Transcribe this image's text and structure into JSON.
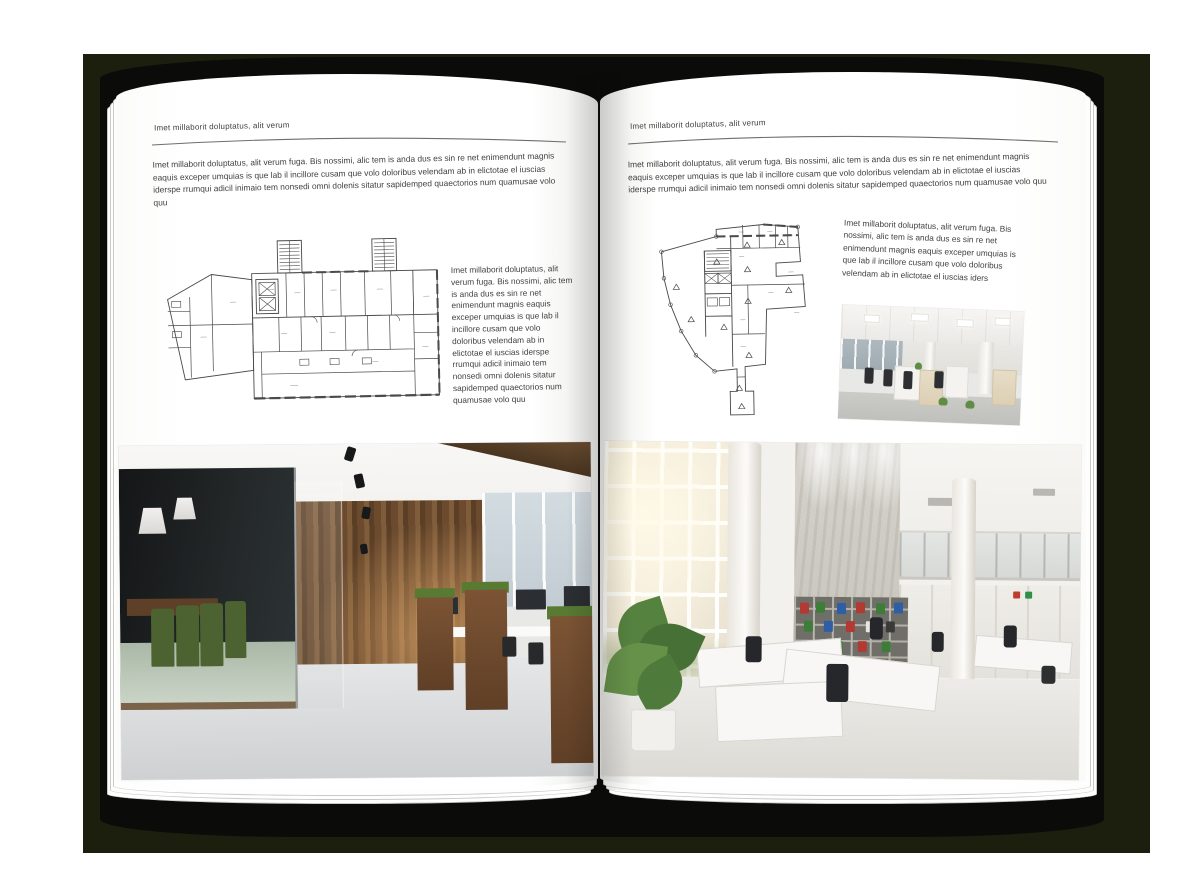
{
  "document": {
    "type": "brochure-spread-mockup",
    "palette": {
      "backdrop": "#1c1e0e",
      "cover": "#0b0b09",
      "page": "#ffffff",
      "body_text": "#3f3f3f",
      "rule": "#6e6e6e",
      "plan_line": "#4a4a4a",
      "binder_red": "#b23a32",
      "binder_green": "#3e7d39",
      "binder_blue": "#2e5ea6",
      "chair_green": "#4d6231"
    },
    "pages": {
      "left": {
        "header": "Imet millaborit doluptatus, alit verum",
        "intro": "Imet millaborit doluptatus, alit verum fuga. Bis nossimi, alic tem is anda dus es sin re net enimendunt magnis eaquis exceper umquias is que lab il incillore cusam que volo doloribus velendam ab in elictotae el iuscias iderspe rrumqui adicil inimaio tem nonsedi omni dolenis sitatur sapidemped quaectorios num quamusae volo quu",
        "side_text": "Imet millaborit doluptatus, alit verum fuga. Bis nossimi, alic tem is anda dus es sin re net enimendunt magnis eaquis exceper umquias is que lab il incillore cusam que volo doloribus velendam ab in elictotae el iuscias iderspe rrumqui adicil inimaio tem nonsedi omni dolenis sitatur sapidemped quaectorios num quamusae volo quu"
      },
      "right": {
        "header": "Imet millaborit doluptatus, alit verum",
        "intro": "Imet millaborit doluptatus, alit verum fuga. Bis nossimi, alic tem is anda dus es sin re net enimendunt magnis eaquis exceper umquias is que lab il incillore cusam que volo doloribus velendam ab in elictotae el iuscias iderspe rrumqui adicil inimaio tem nonsedi omni dolenis sitatur sapidemped quaectorios num quamusae volo quu",
        "side_text": "Imet millaborit doluptatus, alit verum fuga. Bis nossimi, alic tem is anda dus es sin re net enimendunt magnis eaquis exceper umquias is que lab il incillore cusam que volo doloribus velendam ab in elictotae el iuscias iders"
      }
    }
  }
}
